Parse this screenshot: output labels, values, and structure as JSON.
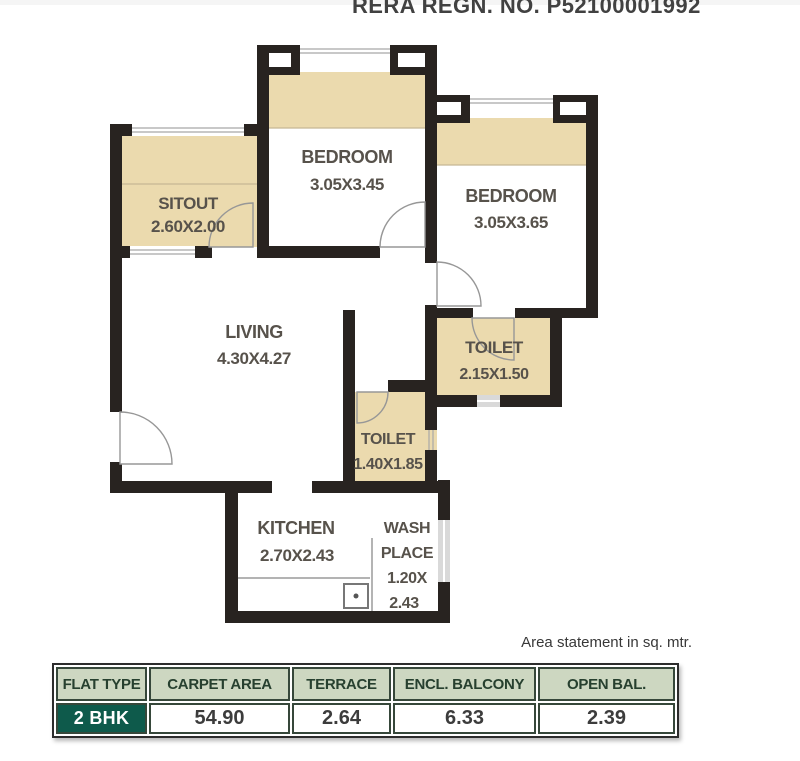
{
  "header": {
    "rera": "RERA REGN. NO. P52100001992"
  },
  "plan": {
    "sitout": {
      "name": "SITOUT",
      "dims": "2.60X2.00"
    },
    "bedroom_top": {
      "name": "BEDROOM",
      "dims": "3.05X3.45"
    },
    "bedroom_right": {
      "name": "BEDROOM",
      "dims": "3.05X3.65"
    },
    "living": {
      "name": "LIVING",
      "dims": "4.30X4.27"
    },
    "toilet_attached": {
      "name": "TOILET",
      "dims": "2.15X1.50"
    },
    "toilet_common": {
      "name": "TOILET",
      "dims": "1.40X1.85"
    },
    "kitchen": {
      "name": "KITCHEN",
      "dims": "2.70X2.43"
    },
    "wash_place": {
      "lines": [
        "WASH",
        "PLACE",
        "1.20X",
        "2.43"
      ]
    }
  },
  "area_note": "Area statement in sq. mtr.",
  "table": {
    "headers": [
      "FLAT TYPE",
      "CARPET AREA",
      "TERRACE",
      "ENCL. BALCONY",
      "OPEN BAL."
    ],
    "row": {
      "flat_type": "2 BHK",
      "carpet_area": "54.90",
      "terrace": "2.64",
      "encl_balcony": "6.33",
      "open_bal": "2.39"
    }
  },
  "colors": {
    "wall": "#282320",
    "beige": "#ebdaae",
    "label": "#57524b",
    "table_header_bg": "#cdd7c1",
    "table_header_text": "#27402f",
    "table_border": "#36473a",
    "flat_badge_bg": "#0e5a4b",
    "flat_badge_text": "#ffffff",
    "value_text": "#3c3c3c"
  }
}
